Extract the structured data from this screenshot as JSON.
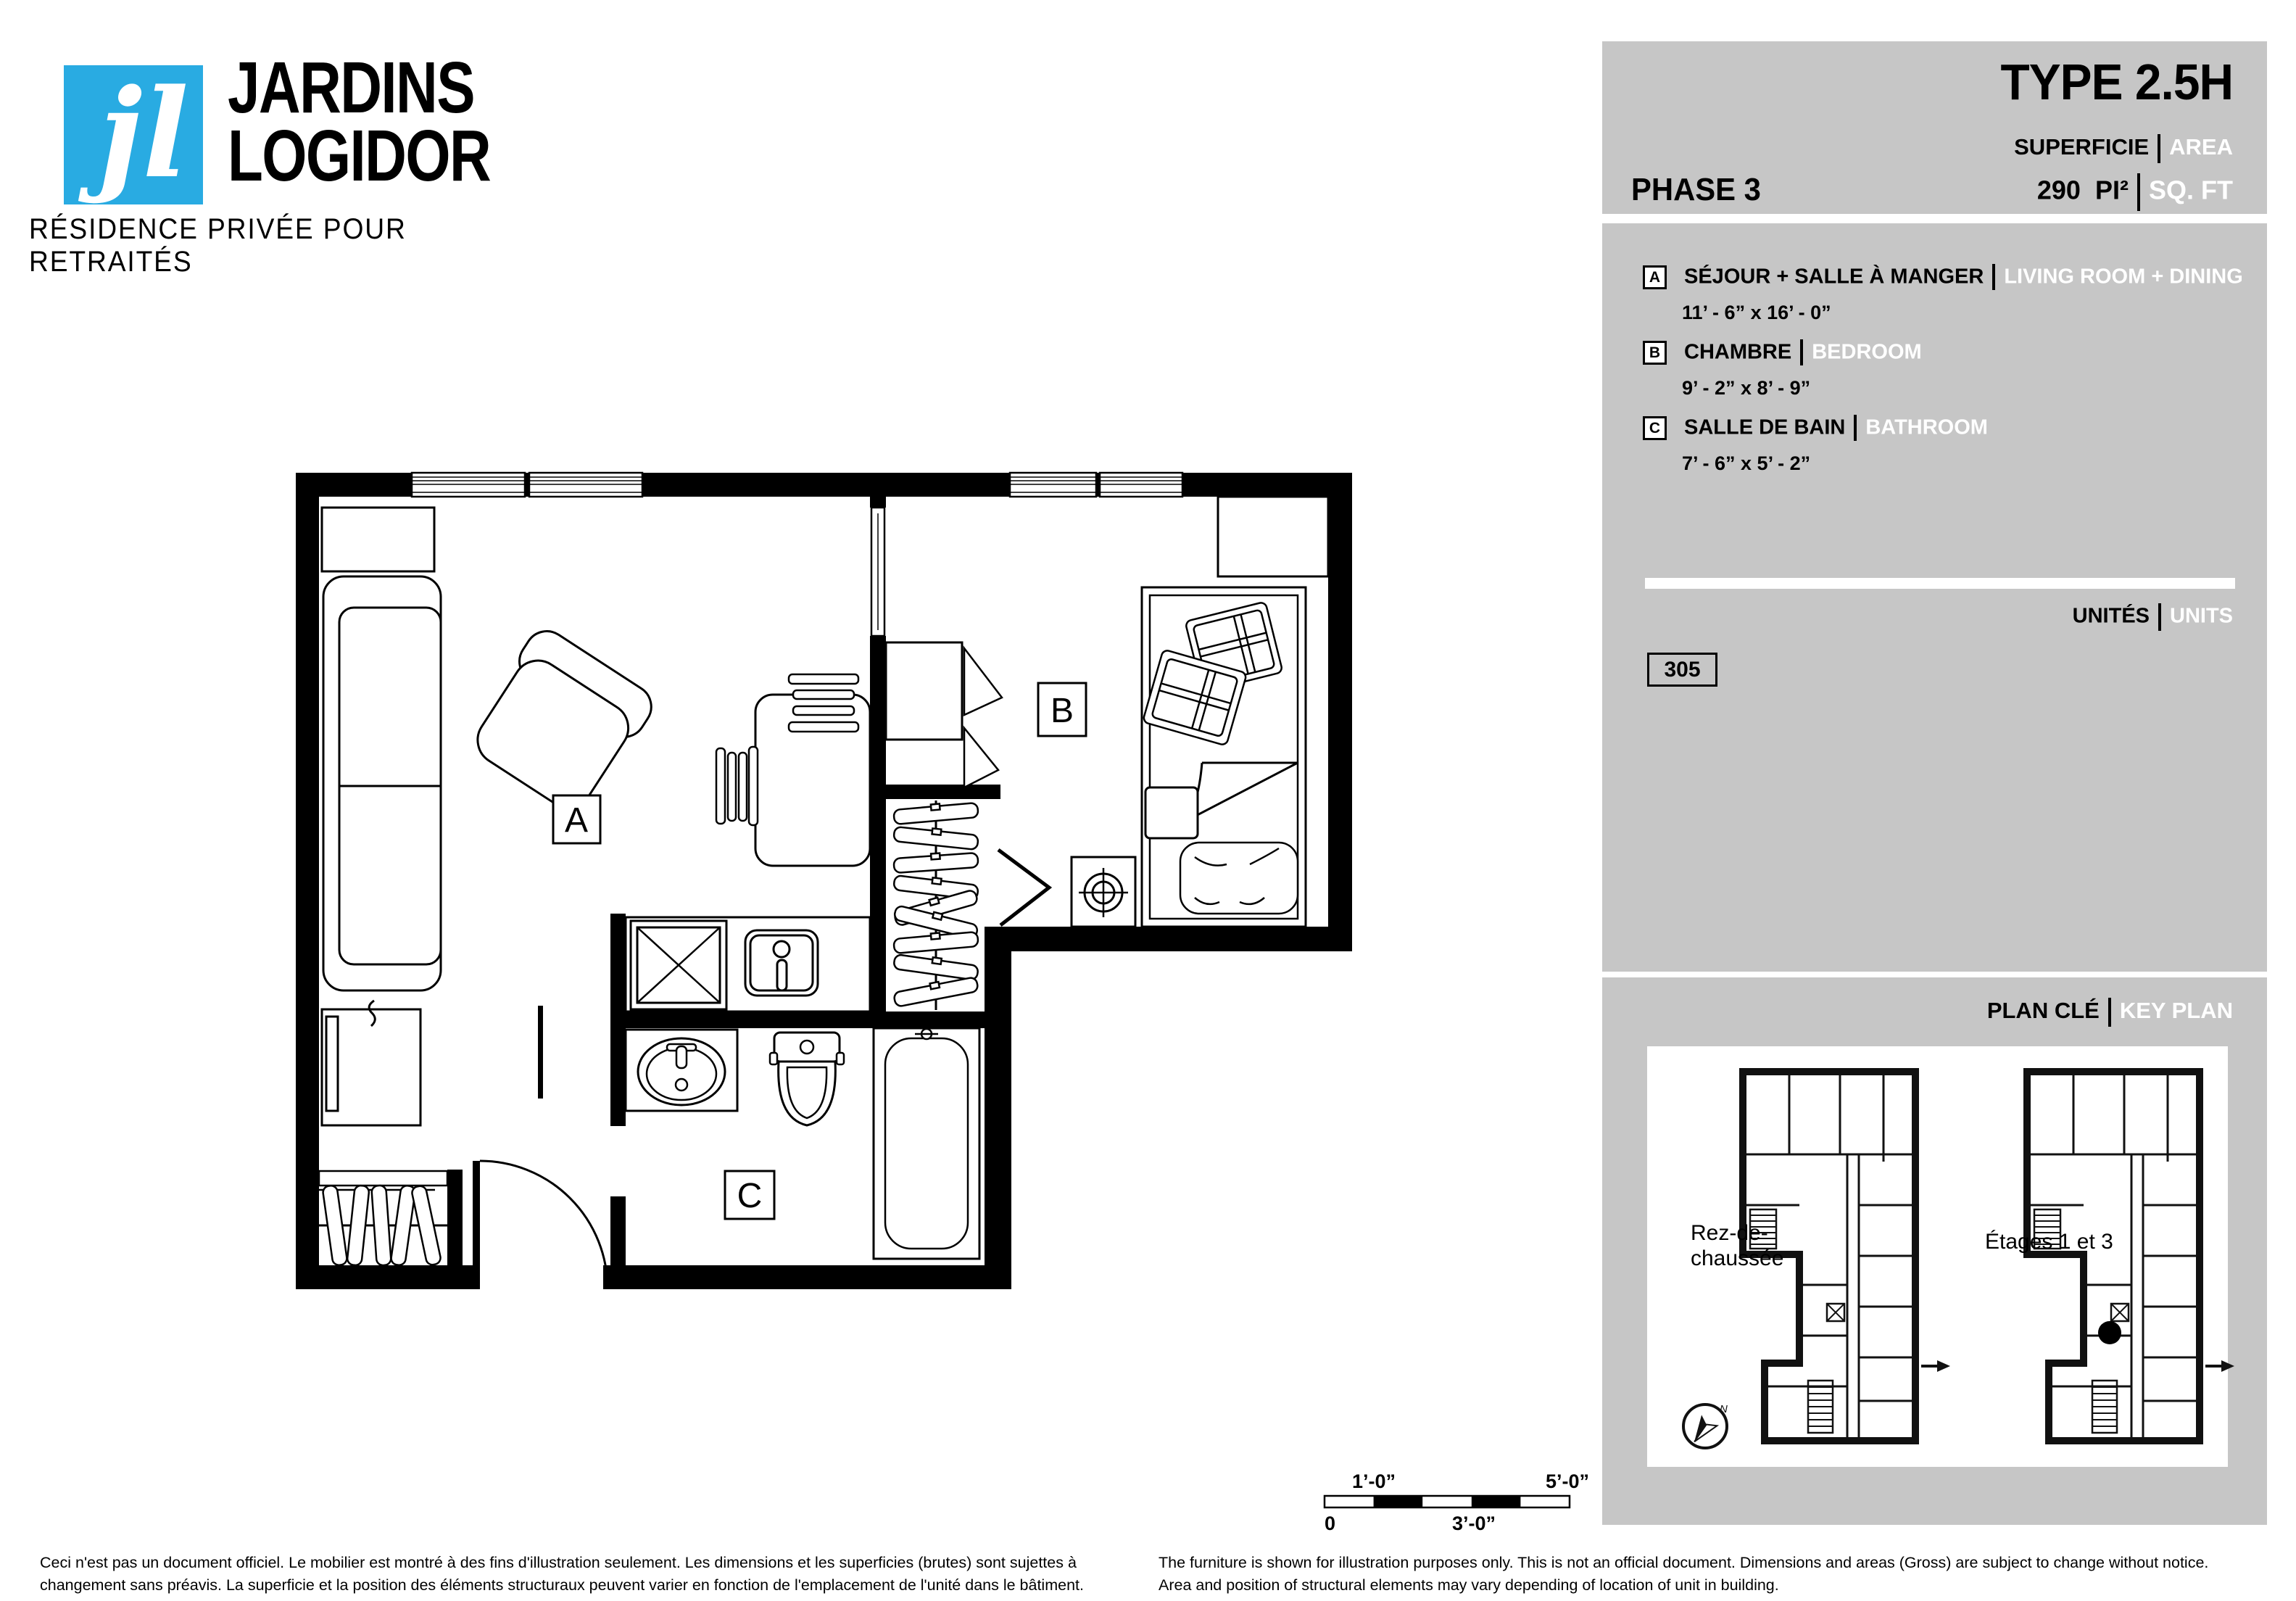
{
  "brand": {
    "monogram": "jl",
    "name_line1": "JARDINS",
    "name_line2": "LOGIDOR",
    "tagline": "RÉSIDENCE PRIVÉE POUR RETRAITÉS"
  },
  "header": {
    "type_title": "TYPE 2.5H",
    "phase": "PHASE 3",
    "superficie_label": "SUPERFICIE",
    "area_label": "AREA",
    "area_value": "290",
    "area_unit_fr": "PI²",
    "area_unit_en": "SQ. FT"
  },
  "legend": {
    "items": [
      {
        "key": "A",
        "label_fr": "SÉJOUR + SALLE À MANGER",
        "label_en": "LIVING ROOM + DINING",
        "dims": "11’ - 6” x 16’ - 0”"
      },
      {
        "key": "B",
        "label_fr": "CHAMBRE",
        "label_en": "BEDROOM",
        "dims": "9’ -  2” x 8’ - 9”"
      },
      {
        "key": "C",
        "label_fr": "SALLE DE BAIN",
        "label_en": "BATHROOM",
        "dims": "7’ -  6” x 5’ - 2”"
      }
    ]
  },
  "units": {
    "label_fr": "UNITÉS",
    "label_en": "UNITS",
    "number": "305"
  },
  "keyplan": {
    "label_fr": "PLAN CLÉ",
    "label_en": "KEY PLAN",
    "left_caption_line1": "Rez-de-",
    "left_caption_line2": "chaussée",
    "right_caption": "Étages 1 et 3",
    "compass_n": "N"
  },
  "plan": {
    "room_a": "A",
    "room_b": "B",
    "room_c": "C"
  },
  "scalebar": {
    "top_left": "1’-0”",
    "top_right": "5’-0”",
    "bottom_left": "0",
    "bottom_mid": "3’-0”"
  },
  "footer": {
    "fr_line1": "Ceci n'est pas un document officiel. Le mobilier est montré à des fins d'illustration seulement. Les dimensions et les superficies (brutes) sont sujettes à",
    "fr_line2": "changement sans préavis. La superficie et la position des éléments structuraux peuvent varier en fonction de l'emplacement de l'unité dans le bâtiment.",
    "en_line1": "The furniture is shown for illustration purposes only. This is not an official document. Dimensions and areas (Gross) are subject to change without notice.",
    "en_line2": "Area and position of structural elements may vary depending of location of unit in building."
  },
  "colors": {
    "brand_cyan": "#29abe2",
    "panel_gray": "#c6c6c6",
    "ink": "#000000"
  }
}
